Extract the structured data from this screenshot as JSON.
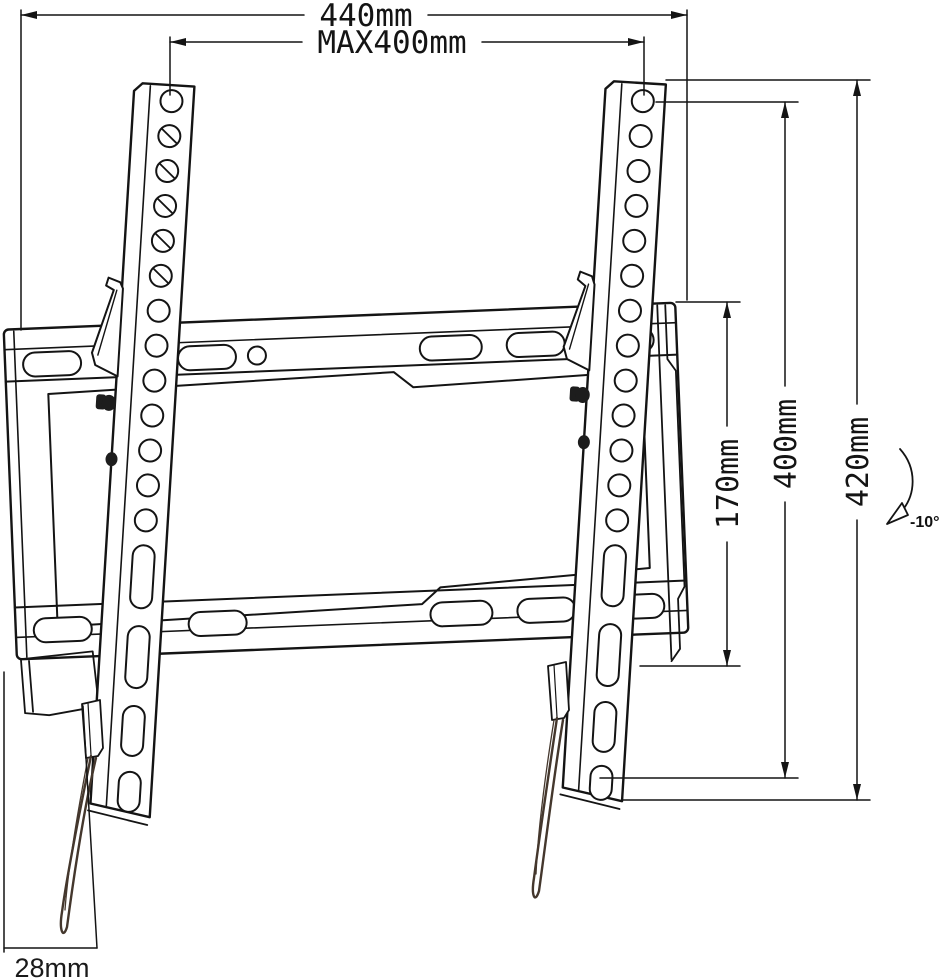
{
  "dimensions": {
    "overall_width": "440mm",
    "max_vesa_width": "MAX400mm",
    "wall_plate_height": "170mm",
    "vesa_height": "400mm",
    "bracket_height": "420mm",
    "tilt_angle": "-10°",
    "bottom_depth": "28mm"
  },
  "colors": {
    "line": "#141414",
    "background": "#ffffff",
    "cord": "#44372d"
  }
}
